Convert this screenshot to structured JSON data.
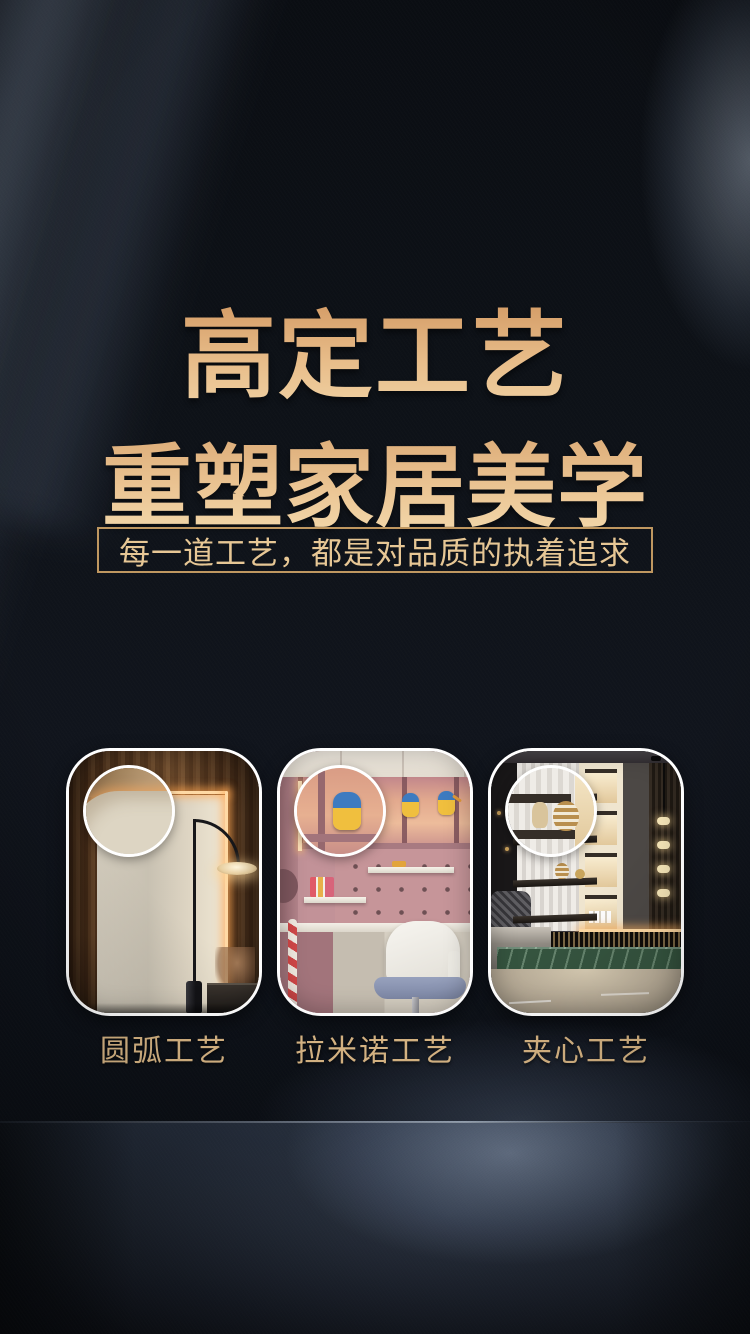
{
  "header": {
    "title_line1": "高定工艺",
    "title_line2": "重塑家居美学",
    "subtitle": "每一道工艺，都是对品质的执着追求"
  },
  "cards": [
    {
      "label": "圆弧工艺",
      "photo": "卧室衣柜圆弧转角实景"
    },
    {
      "label": "拉米诺工艺",
      "photo": "儿童房学习区层板实景"
    },
    {
      "label": "夹心工艺",
      "photo": "客厅展示柜悬浮层板实景"
    }
  ],
  "colors": {
    "title_gold_top": "#d49c66",
    "title_gold_bottom": "#f4dcb0",
    "subtitle_text": "#e7c795",
    "subtitle_border": "#bf9760",
    "caption_gold": "#dcb987",
    "card_border": "#ffffff",
    "background_dark": "#0e1218",
    "glow_blue": "#8fa4c4"
  }
}
